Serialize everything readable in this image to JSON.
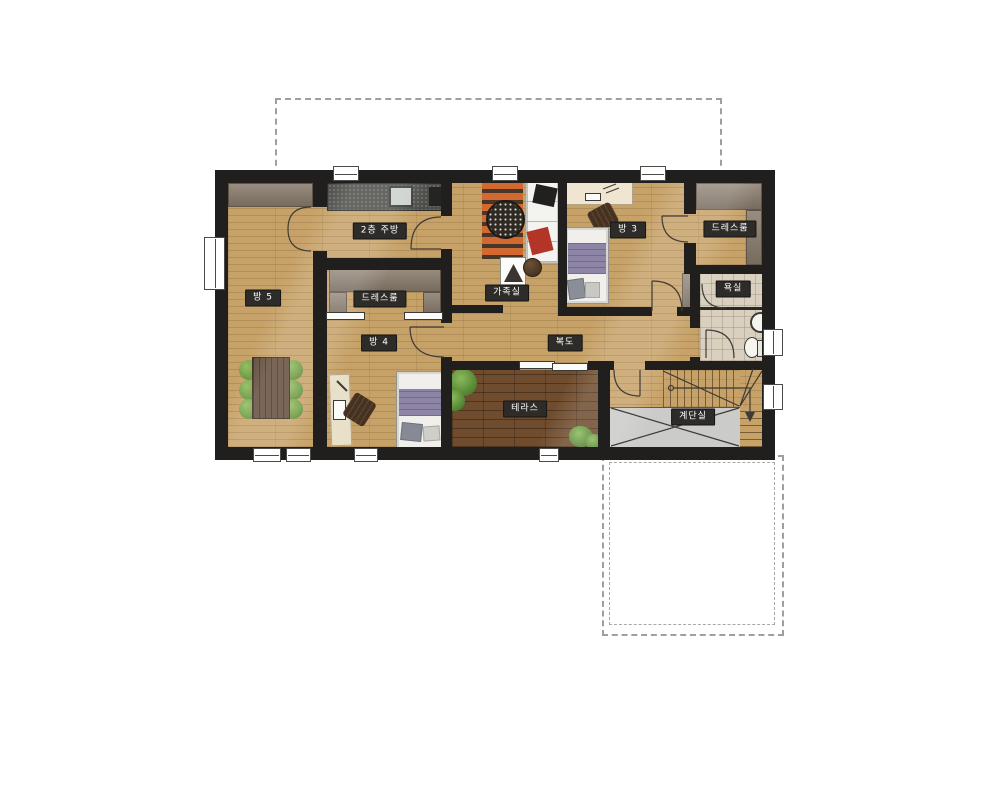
{
  "rooms": [
    {
      "id": "room5",
      "label": "방 5"
    },
    {
      "id": "kitchen_2f",
      "label": "2층 주방"
    },
    {
      "id": "dressroom_left",
      "label": "드레스룸"
    },
    {
      "id": "family_room",
      "label": "가족실"
    },
    {
      "id": "room3",
      "label": "방 3"
    },
    {
      "id": "dressroom_right",
      "label": "드레스룸"
    },
    {
      "id": "bathroom",
      "label": "욕실"
    },
    {
      "id": "room4",
      "label": "방 4"
    },
    {
      "id": "corridor",
      "label": "복도"
    },
    {
      "id": "terrace",
      "label": "테라스"
    },
    {
      "id": "stairwell",
      "label": "계단실"
    }
  ],
  "colors": {
    "wall": "#211f1d",
    "floor_light_wood": "#c7a268",
    "terrace_wood": "#6f4c2d",
    "closet_taupe": "#8b7d6e",
    "kitchen_counter": "#4d4d49",
    "bathroom_tile": "#d9d0c0",
    "stair_void_gray": "#cbcbc9",
    "rug_orange": "#d4692f",
    "chair_green": "#6f9c43",
    "bed_blanket_purple": "#8e85a6",
    "label_bg": "#2e2c29",
    "label_text": "#ffffff",
    "dashed_outline": "#9f9f9f"
  }
}
